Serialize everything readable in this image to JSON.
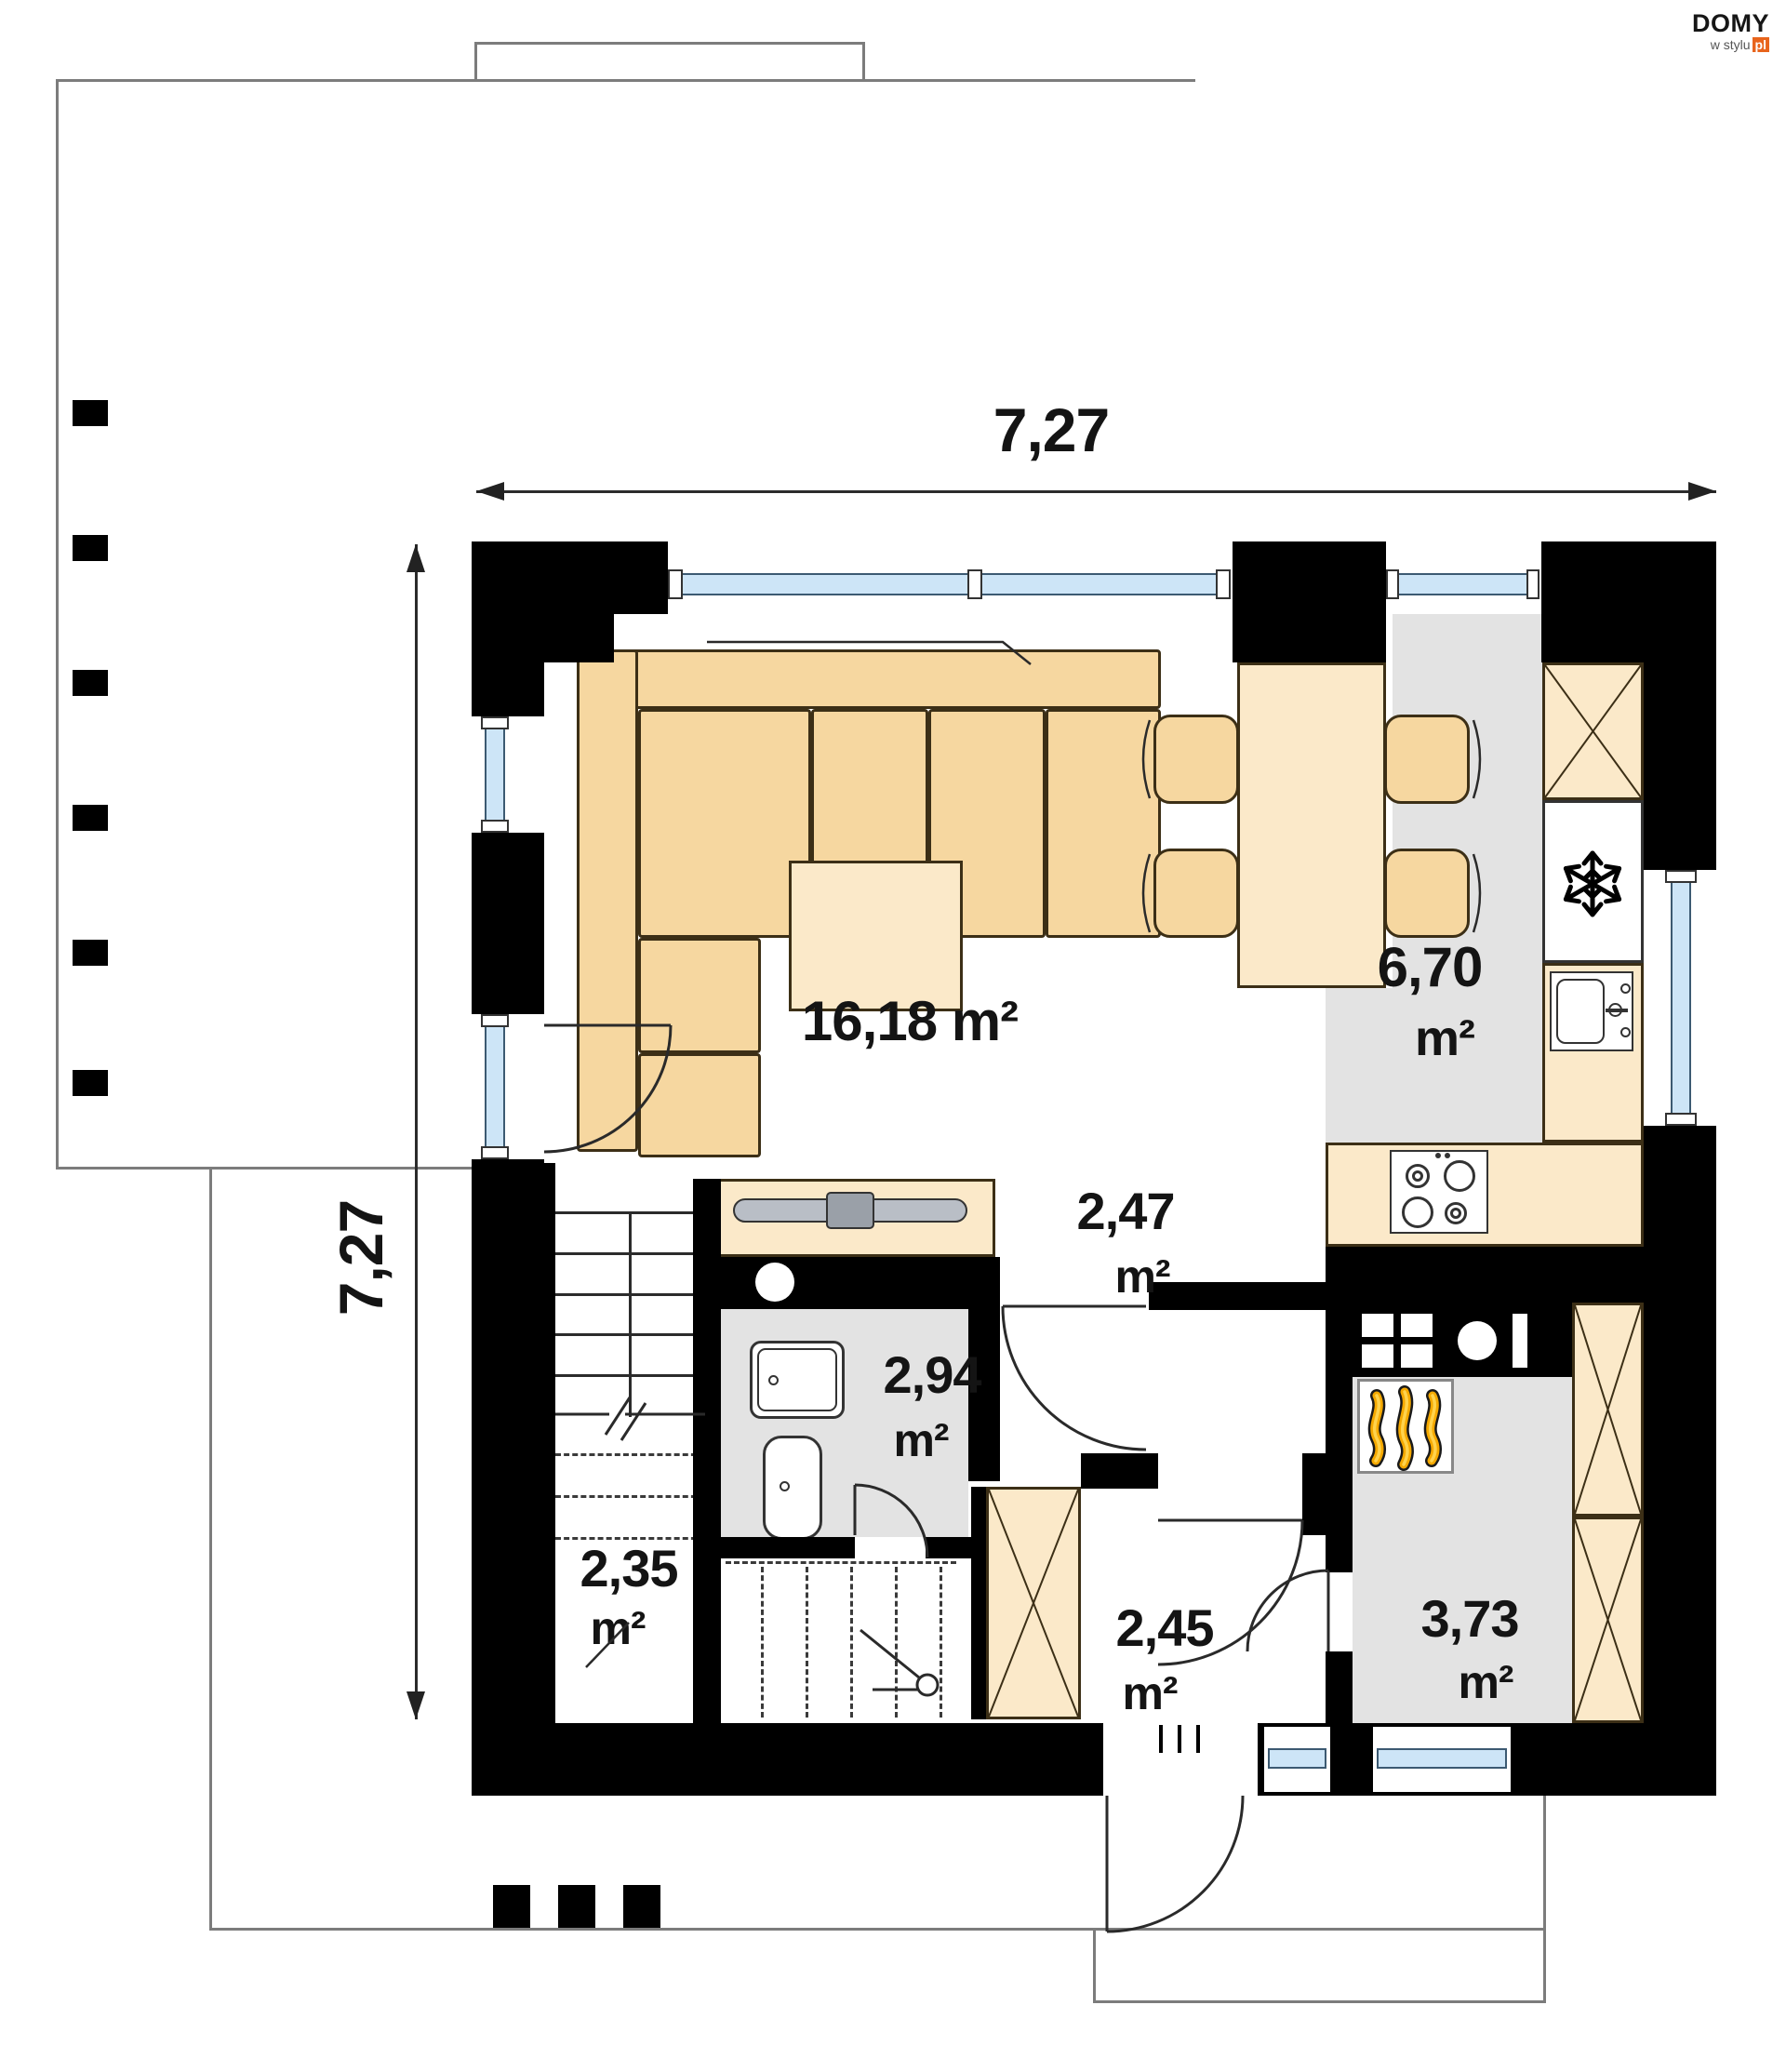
{
  "logo": {
    "brand": "DOMY",
    "sub": "w stylu",
    "tld": "pl"
  },
  "dimensions": {
    "width_label": "7,27",
    "height_label": "7,27"
  },
  "rooms": {
    "living_dining": {
      "area": "16,18",
      "unit": "m²"
    },
    "kitchen": {
      "area": "6,70",
      "unit": "m²"
    },
    "hall": {
      "area": "2,47",
      "unit": "m²"
    },
    "bathroom": {
      "area": "2,94",
      "unit": "m²"
    },
    "stairs": {
      "area": "2,35",
      "unit": "m²"
    },
    "vestibule": {
      "area": "2,45",
      "unit": "m²"
    },
    "boiler_room": {
      "area": "3,73",
      "unit": "m²"
    }
  },
  "icons": {
    "fridge": "snowflake",
    "boiler": "flames",
    "wardrobe": "x-cross",
    "washer": "circle"
  },
  "colors": {
    "wall": "#000000",
    "floor_gray": "#e3e3e3",
    "furniture": "#f6d7a0",
    "furniture_light": "#fbe9c9",
    "glass": "#cde5f7",
    "outline": "#7c7c7c",
    "flame_orange": "#f5a900",
    "logo_accent": "#e8641c"
  }
}
